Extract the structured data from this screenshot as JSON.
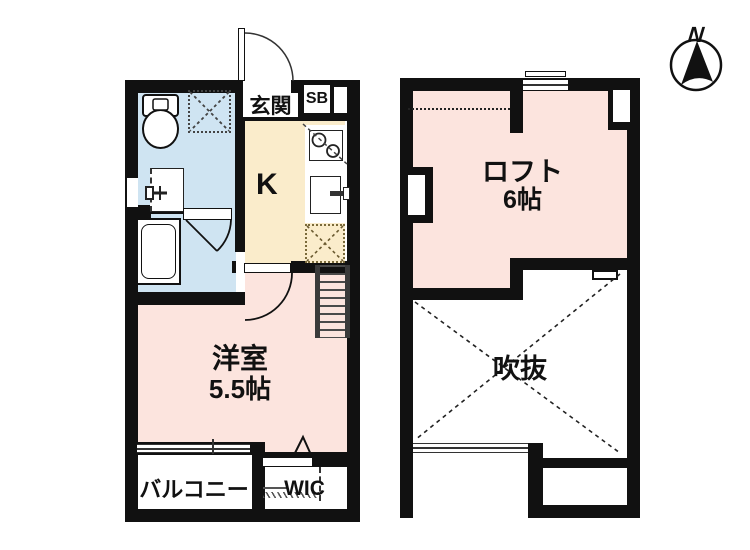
{
  "title": "apartment-floor-plan",
  "floor1": {
    "entrance_label": "玄関",
    "shoebox_label": "SB",
    "kitchen_label": "K",
    "room_label": "洋室",
    "room_size": "5.5帖",
    "balcony_label": "バルコニー",
    "wic_label": "WIC"
  },
  "floor2": {
    "loft_label": "ロフト",
    "loft_size": "6帖",
    "void_label": "吹抜"
  },
  "compass": {
    "north_label": "N"
  },
  "colors": {
    "wall": "#111111",
    "washroom_blue": "#cfe4f2",
    "kitchen_cream": "#faeccb",
    "room_pink": "#fce4de",
    "background": "#ffffff"
  },
  "icons": {
    "toilet": "toilet-icon",
    "laundry_space": "laundry-space-icon",
    "washbasin": "washbasin-icon",
    "bathtub": "bathtub-icon",
    "stove": "stove-icon",
    "kitchen_sink": "kitchen-sink-icon",
    "refrigerator_space": "refrigerator-space-icon",
    "ladder": "loft-ladder-icon",
    "void_cross": "void-cross-icon",
    "north_compass": "north-compass-icon"
  }
}
